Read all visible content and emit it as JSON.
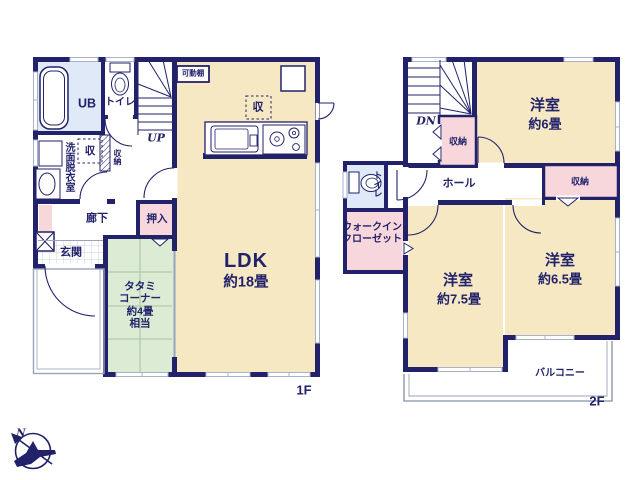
{
  "colors": {
    "wall_navy": "#22226b",
    "room_cream": "#f7e8c4",
    "tatami_green": "#dcebd3",
    "closet_pink": "#f8d7dc",
    "wet_area_blue": "#dfe9f7",
    "window_gray": "#a8b2c8",
    "outline_gray": "#9aa3b8"
  },
  "floor1": {
    "floor_label": "1F",
    "labels": {
      "ub": "UB",
      "toilet": "トイレ",
      "washroom": "洗面脱衣室",
      "storage": "収",
      "storage2": "収納",
      "corridor": "廊下",
      "entrance": "玄関",
      "closet": "押入",
      "tatami": "タタミ\nコーナー\n約4畳\n相当",
      "ldk": "LDK",
      "ldk_size": "約18畳",
      "shelf": "可動棚",
      "ldk_storage": "収",
      "up": "UP"
    }
  },
  "floor2": {
    "floor_label": "2F",
    "labels": {
      "dn": "DN",
      "storage_left": "収納",
      "room6": "洋室",
      "room6_size": "約6畳",
      "hall": "ホール",
      "storage_right": "収納",
      "toilet": "トイレ",
      "wic": "ウォークイン\nクローゼット",
      "room75": "洋室",
      "room75_size": "約7.5畳",
      "room65": "洋室",
      "room65_size": "約6.5畳",
      "balcony": "バルコニー"
    }
  },
  "compass": {
    "north": "N"
  }
}
